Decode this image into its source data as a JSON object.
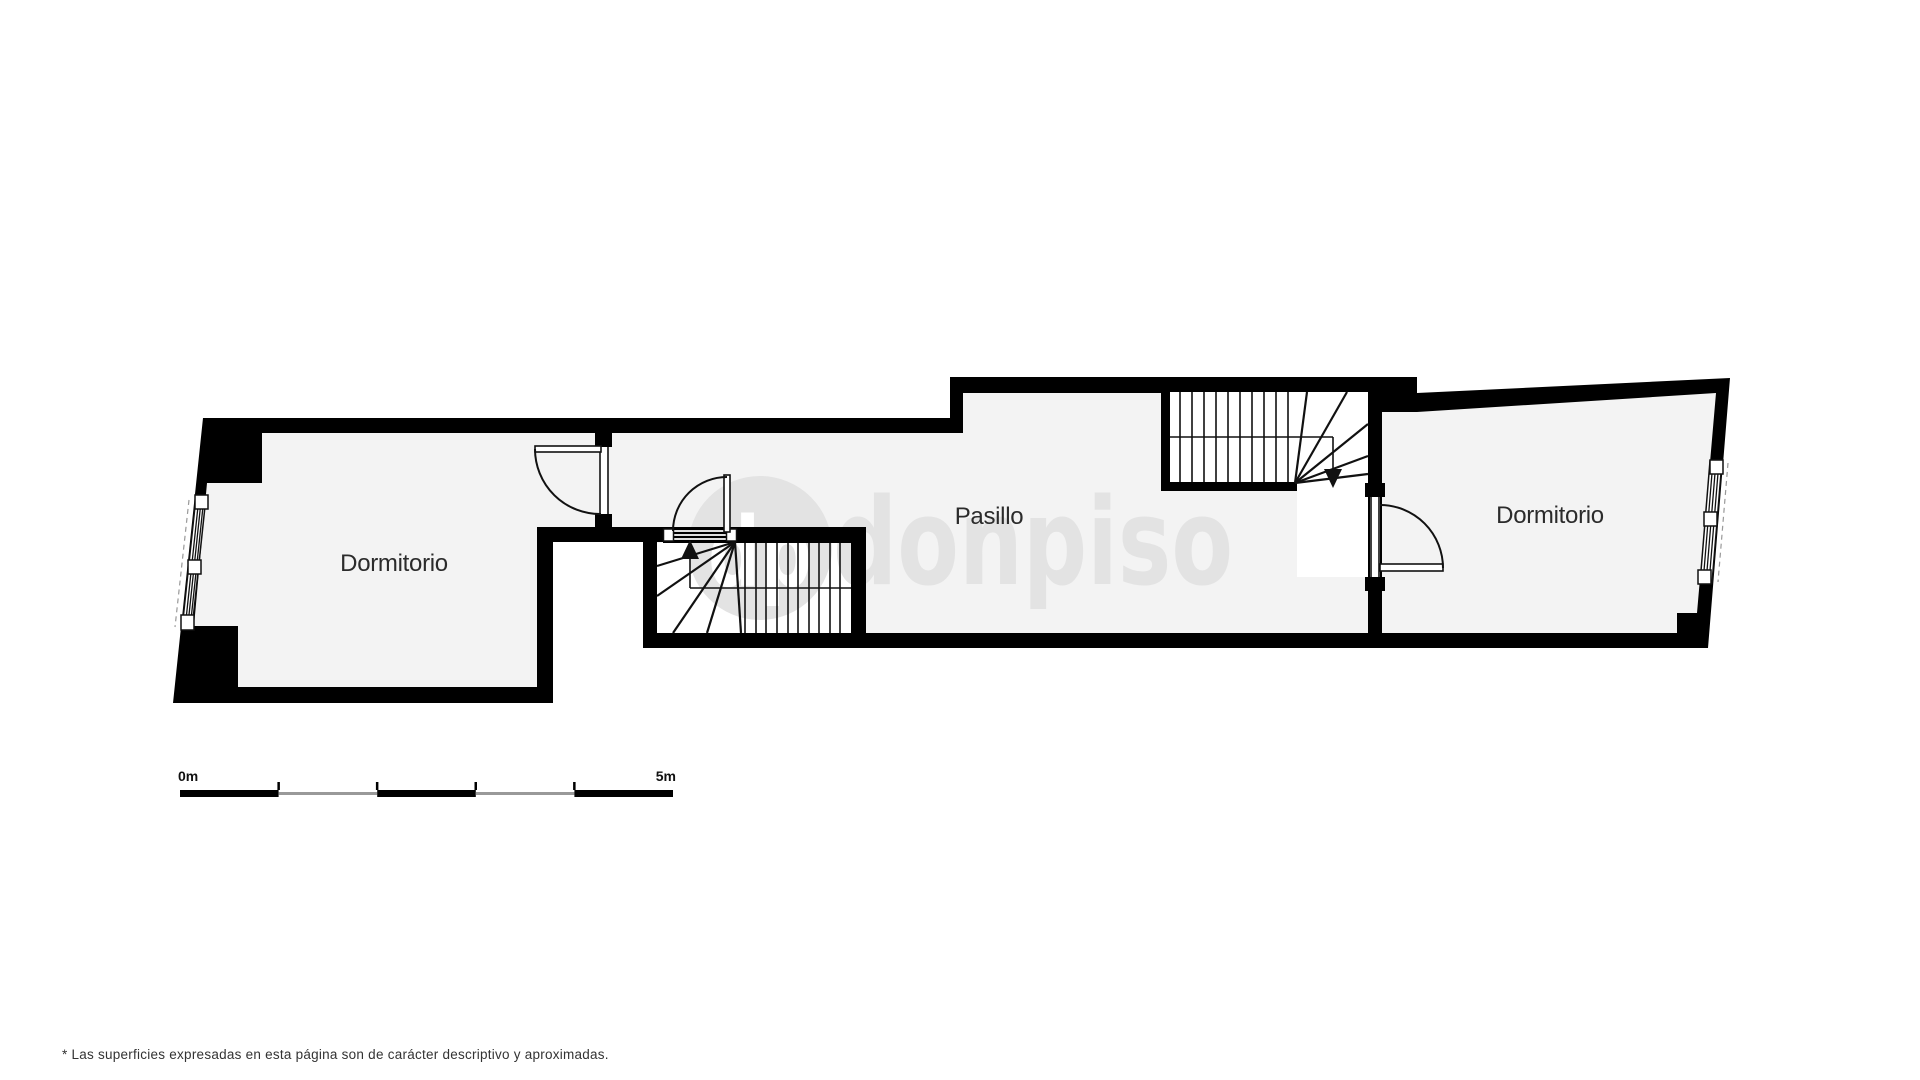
{
  "plan": {
    "rooms": {
      "left_bedroom": {
        "label": "Dormitorio"
      },
      "hallway": {
        "label": "Pasillo"
      },
      "right_bedroom": {
        "label": "Dormitorio"
      }
    }
  },
  "watermark": {
    "logo": "dp",
    "brand": "donpiso"
  },
  "scale_bar": {
    "start_label": "0m",
    "end_label": "5m"
  },
  "footer": {
    "disclaimer": "* Las superficies expresadas en esta página son de carácter descriptivo y aproximadas."
  },
  "colors": {
    "wall": "#000000",
    "floor": "#f3f3f3",
    "stair_interior": "#ffffff",
    "watermark": "#e3e3e3",
    "scale_alt_segment": "#999999",
    "label_text": "#2b2b2b",
    "disclaimer_text": "#333333"
  }
}
